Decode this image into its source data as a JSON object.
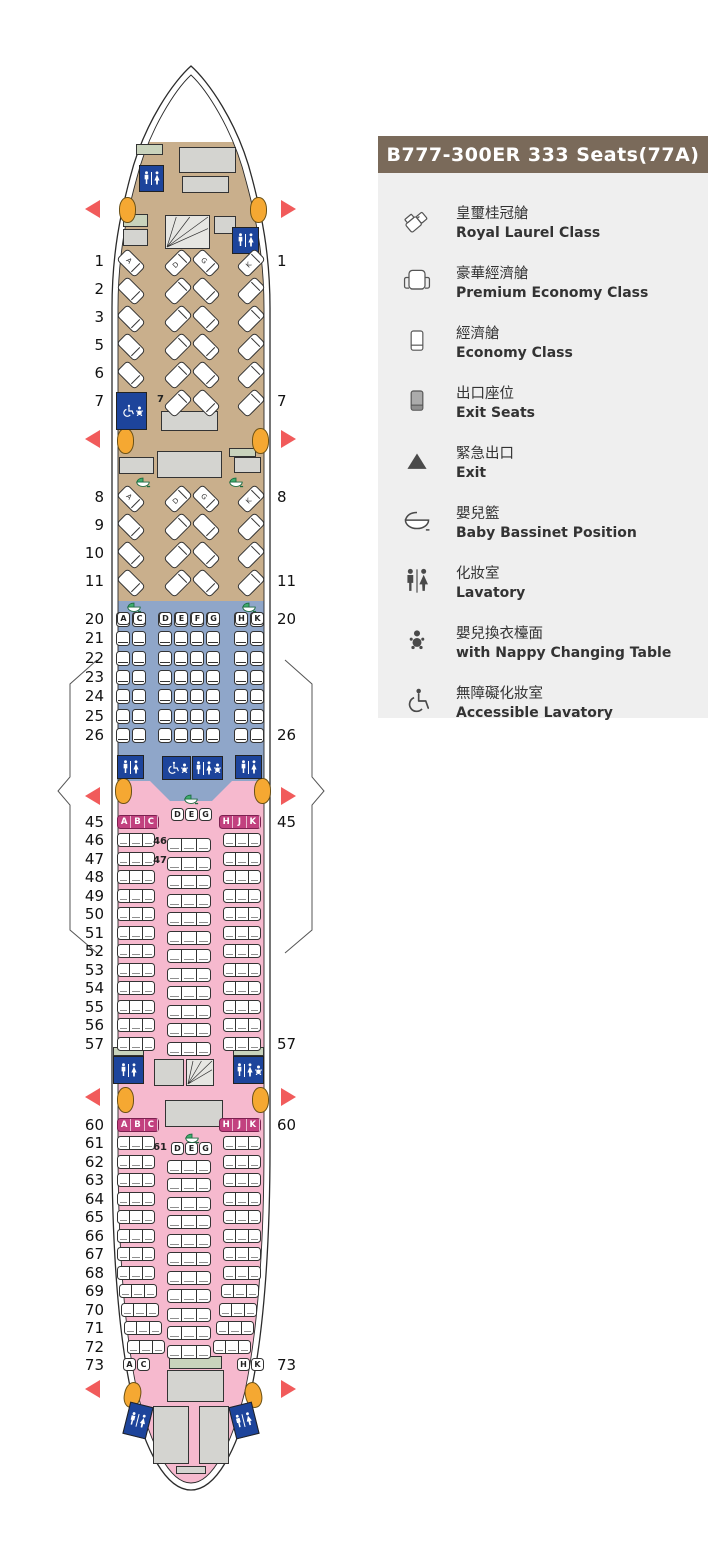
{
  "legend": {
    "title": "B777-300ER 333 Seats(77A)",
    "items": [
      {
        "icon": "royal-laurel-seat-icon",
        "zh": "皇璽桂冠艙",
        "en": "Royal Laurel Class"
      },
      {
        "icon": "premium-economy-seat-icon",
        "zh": "豪華經濟艙",
        "en": "Premium Economy Class"
      },
      {
        "icon": "economy-seat-icon",
        "zh": "經濟艙",
        "en": "Economy Class"
      },
      {
        "icon": "exit-seat-icon",
        "zh": "出口座位",
        "en": "Exit Seats"
      },
      {
        "icon": "exit-triangle-icon",
        "zh": "緊急出口",
        "en": "Exit"
      },
      {
        "icon": "baby-bassinet-icon",
        "zh": "嬰兒籃",
        "en": "Baby Bassinet Position"
      },
      {
        "icon": "lavatory-icon",
        "zh": "化妝室",
        "en": "Lavatory"
      },
      {
        "icon": "nappy-changing-icon",
        "zh": "嬰兒換衣檯面",
        "en": "with Nappy Changing Table"
      },
      {
        "icon": "accessible-lavatory-icon",
        "zh": "無障礙化妝室",
        "en": "Accessible Lavatory"
      }
    ]
  },
  "colors": {
    "royal_laurel_bg": "#C9AF8C",
    "premium_bg": "#8FA6C9",
    "economy_bg": "#F6B9CE",
    "exit_seat": "#C2417F",
    "exit_triangle": "#F15B5B",
    "lavatory_blue": "#1D449B",
    "door_orange": "#F5A832",
    "bassinet_green": "#3FAE6E",
    "galley_grey": "#D4D4D0",
    "galley_green": "#C9D3BC",
    "legend_header": "#7A6A5A",
    "legend_bg": "#EFEFEF"
  },
  "seatmap": {
    "royal_laurel": {
      "cabin1_rows": [
        "1",
        "2",
        "3",
        "5",
        "6",
        "7"
      ],
      "cabin2_rows": [
        "8",
        "9",
        "10",
        "11"
      ],
      "letters": [
        "A",
        "D",
        "G",
        "K"
      ],
      "letter_rows": [
        "1",
        "8"
      ],
      "no_left_seat_row": "7"
    },
    "premium_economy": {
      "rows": [
        "20",
        "21",
        "22",
        "23",
        "24",
        "25",
        "26"
      ],
      "letters_left": [
        "A",
        "C"
      ],
      "letters_center": [
        "D",
        "E",
        "F",
        "G"
      ],
      "letters_right": [
        "H",
        "K"
      ]
    },
    "economy_front": {
      "side_rows": [
        "45",
        "46",
        "47",
        "48",
        "49",
        "50",
        "51",
        "52",
        "53",
        "54",
        "55",
        "56",
        "57"
      ],
      "center_rows": [
        "46",
        "47",
        "48",
        "49",
        "50",
        "51",
        "52",
        "53",
        "54",
        "55",
        "56",
        "57"
      ],
      "exit_row": "45",
      "exit_letters_left": [
        "A",
        "B",
        "C"
      ],
      "exit_letters_right": [
        "H",
        "J",
        "K"
      ],
      "center_header_letters": [
        "D",
        "E",
        "G"
      ],
      "inline_labels": [
        "46",
        "47"
      ]
    },
    "economy_rear": {
      "side_rows": [
        "60",
        "61",
        "62",
        "63",
        "64",
        "65",
        "66",
        "67",
        "68",
        "69",
        "70",
        "71",
        "72"
      ],
      "center_rows": [
        "61",
        "62",
        "63",
        "64",
        "65",
        "66",
        "67",
        "68",
        "69",
        "70",
        "71",
        "72"
      ],
      "exit_row": "60",
      "exit_letters_left": [
        "A",
        "B",
        "C"
      ],
      "exit_letters_right": [
        "H",
        "J",
        "K"
      ],
      "center_header_letters": [
        "D",
        "E",
        "G"
      ],
      "inline_label": "61",
      "last_row": "73",
      "last_row_letters_left": [
        "A",
        "C"
      ],
      "last_row_letters_right": [
        "H",
        "K"
      ]
    },
    "row7_inline_label": "7",
    "right_side_labels": [
      "1",
      "7",
      "8",
      "11",
      "20",
      "26",
      "45",
      "57",
      "60",
      "73"
    ]
  }
}
